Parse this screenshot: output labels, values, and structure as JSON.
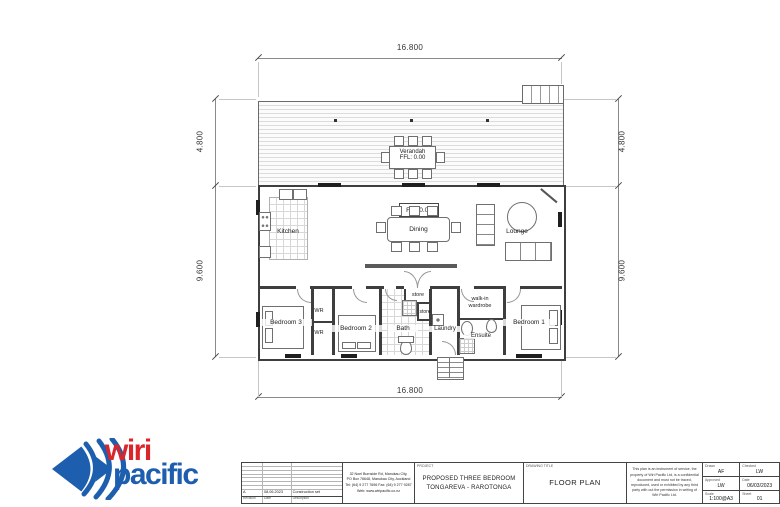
{
  "drawing": {
    "dim": {
      "top": "16.800",
      "bottom": "16.800",
      "left_upper": "4.800",
      "left_lower": "9.600",
      "right_upper": "4.800",
      "right_lower": "9.600"
    },
    "labels": {
      "verandah": "Verandah",
      "verandah_ffl": "FFL: 0.00",
      "ffl_main": "FFL 0.00",
      "kitchen": "Kitchen",
      "dining": "Dining",
      "lounge": "Lounge",
      "bedroom1": "Bedroom 1",
      "bedroom2": "Bedroom 2",
      "bedroom3": "Bedroom 3",
      "bath": "Bath",
      "laundry": "Laundry",
      "ensuite": "Ensuite",
      "store_entry": "store",
      "store_hall": "store",
      "wr_top": "WR",
      "wr_bottom": "WR",
      "walkin_line1": "walk-in",
      "walkin_line2": "wardrobe"
    }
  },
  "logo": {
    "word1": "wiri",
    "word2": "pacific"
  },
  "title_block": {
    "revision": {
      "headers": [
        "Revision",
        "Date",
        "Description"
      ],
      "row": {
        "rev": "A",
        "date": "08.06.2023",
        "desc": "Construction set"
      }
    },
    "address": [
      "32 Noel Burnside Rd, Manukau City,",
      "PO Box 76648, Manukau City, Auckland",
      "Tel: (64) 9 277 7696  Fax: (64) 9 277 9287",
      "Web: www.wiripacific.co.nz"
    ],
    "project": {
      "label": "PROJECT",
      "line1": "PROPOSED THREE BEDROOM",
      "line2": "TONGAREVA - RAROTONGA"
    },
    "drawing_title": {
      "label": "DRAWING TITLE",
      "value": "FLOOR PLAN"
    },
    "disclaimer": "This plan is an instrument of service, the property of Wiri Pacific Ltd, is a confidential document and must not be traced, reproduced, used or exhibited by any third party with out the permission in writing of Wiri Pacific Ltd.",
    "fields": [
      {
        "label": "Drawn",
        "value": "AF"
      },
      {
        "label": "Checked",
        "value": "LW"
      },
      {
        "label": "Approved",
        "value": "LW"
      },
      {
        "label": "Date",
        "value": "06/03/2023"
      },
      {
        "label": "Scale",
        "value": "1:100@A3"
      },
      {
        "label": "Sheet",
        "value": "01"
      }
    ],
    "colors": {
      "logo_blue": "#1d5fae",
      "logo_red": "#d9252b"
    }
  }
}
